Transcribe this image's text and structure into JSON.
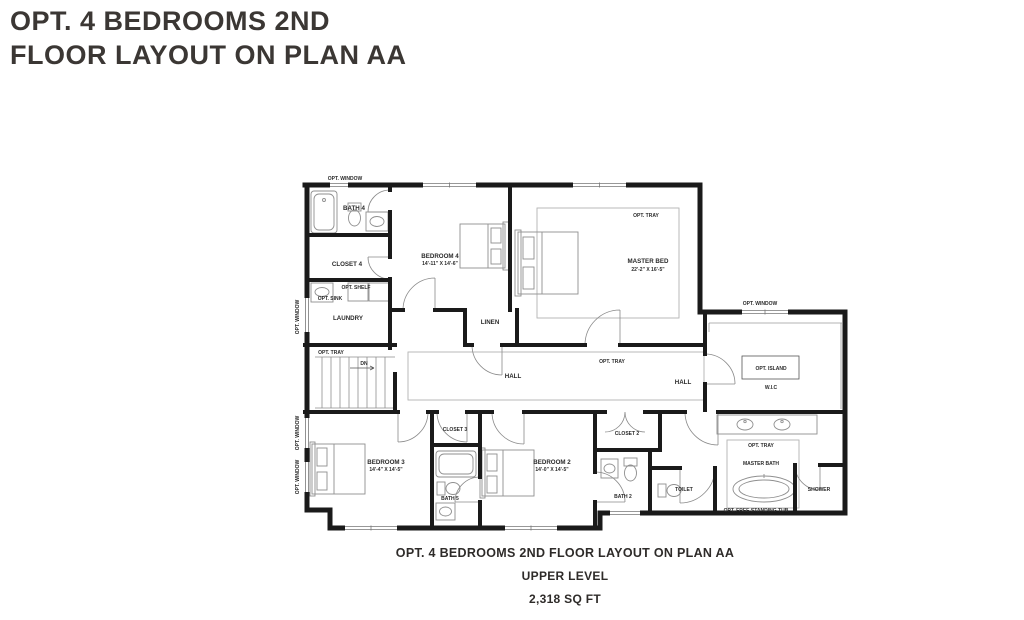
{
  "title": {
    "line1": "OPT. 4 BEDROOMS 2ND",
    "line2": "FLOOR LAYOUT ON PLAN AA"
  },
  "caption": {
    "line1": "OPT. 4 BEDROOMS 2ND FLOOR LAYOUT ON PLAN AA",
    "line2": "UPPER LEVEL",
    "line3": "2,318 SQ FT"
  },
  "plan": {
    "rooms": {
      "bath4": {
        "label": "BATH 4"
      },
      "closet4": {
        "label": "CLOSET 4"
      },
      "opt_shelf": {
        "label": "OPT. SHELF"
      },
      "opt_sink": {
        "label": "OPT. SINK"
      },
      "laundry": {
        "label": "LAUNDRY"
      },
      "stairs_tray": {
        "label": "OPT. TRAY"
      },
      "stairs_dn": {
        "label": "DN"
      },
      "bedroom4": {
        "label": "BEDROOM 4",
        "dims": "14'-11\" X 14'-6\""
      },
      "master_bed": {
        "label": "MASTER BED",
        "dims": "22'-2\" X 16'-5\""
      },
      "master_tray": {
        "label": "OPT. TRAY"
      },
      "linen": {
        "label": "LINEN"
      },
      "hall": {
        "label": "HALL"
      },
      "hall_tray": {
        "label": "OPT. TRAY"
      },
      "hall2": {
        "label": "HALL"
      },
      "wic": {
        "label": "W.I.C"
      },
      "opt_island": {
        "label": "OPT. ISLAND"
      },
      "closet3": {
        "label": "CLOSET 3"
      },
      "closet2": {
        "label": "CLOSET 2"
      },
      "bedroom3": {
        "label": "BEDROOM 3",
        "dims": "14'-4\" X 14'-5\""
      },
      "bedroom2": {
        "label": "BEDROOM 2",
        "dims": "14'-0\" X 14'-5\""
      },
      "bath5": {
        "label": "BATH 5"
      },
      "bath2": {
        "label": "BATH 2"
      },
      "toilet": {
        "label": "TOILET"
      },
      "master_bath": {
        "label": "MASTER BATH"
      },
      "mb_tray": {
        "label": "OPT. TRAY"
      },
      "free_tub": {
        "label": "OPT. FREE STANDING TUB"
      },
      "shower": {
        "label": "SHOWER"
      }
    },
    "windows": {
      "top": "OPT. WINDOW",
      "right": "OPT. WINDOW",
      "left1": "OPT. WINDOW",
      "left2": "OPT. WINDOW",
      "left3": "OPT. WINDOW"
    },
    "colors": {
      "wall": "#1a1a1a",
      "fixture": "#8f8f8f",
      "tray": "#b3b3b3"
    }
  }
}
